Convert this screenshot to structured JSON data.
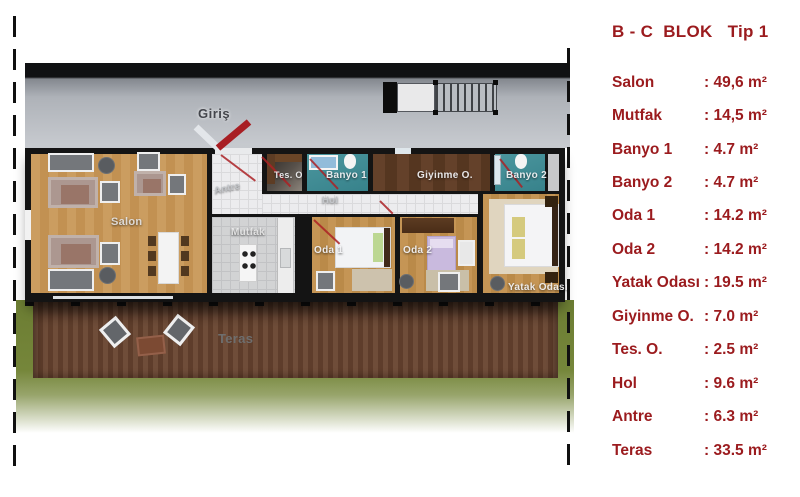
{
  "legend": {
    "title": "B - C  BLOK   Tip 1",
    "rows": [
      {
        "label": "Salon",
        "value": ": 49,6 m²"
      },
      {
        "label": "Mutfak",
        "value": ": 14,5 m²"
      },
      {
        "label": "Banyo 1",
        "value": ": 4.7 m²"
      },
      {
        "label": "Banyo 2",
        "value": ": 4.7 m²"
      },
      {
        "label": "Oda 1",
        "value": ": 14.2 m²"
      },
      {
        "label": "Oda 2",
        "value": ": 14.2 m²"
      },
      {
        "label": "Yatak Odası",
        "value": ": 19.5 m²"
      },
      {
        "label": "Giyinme O.",
        "value": ": 7.0 m²"
      },
      {
        "label": "Tes. O.",
        "value": ": 2.5 m²"
      },
      {
        "label": "Hol",
        "value": ": 9.6 m²"
      },
      {
        "label": "Antre",
        "value": ": 6.3 m²"
      },
      {
        "label": "Teras",
        "value": ": 33.5 m²"
      }
    ]
  },
  "plan": {
    "labels": {
      "giris": "Giriş",
      "salon": "Salon",
      "antre": "Antre",
      "tes_o": "Tes. O",
      "banyo1": "Banyo 1",
      "hol": "Hol",
      "giyinme": "Giyinme O.",
      "banyo2": "Banyo 2",
      "mutfak": "Mutfak",
      "oda1": "Oda 1",
      "oda2": "Oda 2",
      "yatak": "Yatak Odası",
      "teras": "Teras"
    }
  },
  "colors": {
    "accent_maroon": "#9B1B1E",
    "bathroom_teal": "#3F8E96",
    "wood_floor": "#C79A5C",
    "dark_wood": "#5E3B22",
    "deck_brown": "#6B4A38",
    "grass_green": "#6F8035",
    "concrete_gray": "#B9BDC3",
    "wall_black": "#141414",
    "door_swing_red": "#AB2125",
    "arrow_red": "#A81E23",
    "arrow_white": "#E3E6EA"
  }
}
